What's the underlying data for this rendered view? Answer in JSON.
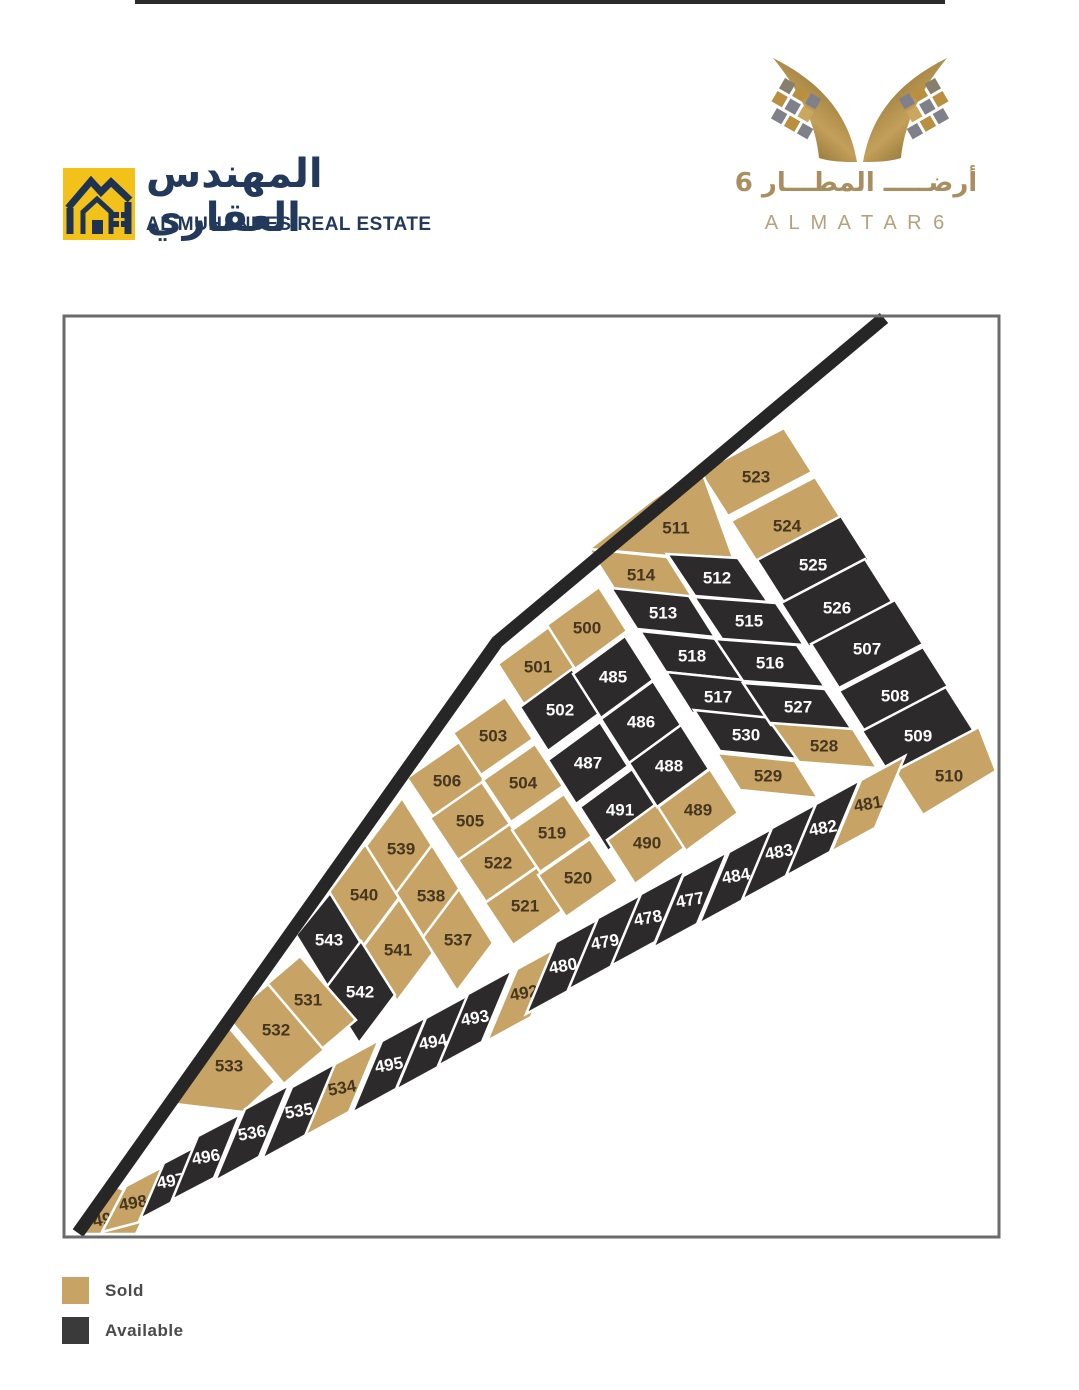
{
  "header": {
    "left": {
      "arabic_title": "المهندس العقاري",
      "english_title": "AL MUHANDES REAL ESTATE",
      "navy": "#22395B",
      "yellow": "#F2C21B"
    },
    "right": {
      "arabic_name": "أرضـــــ المطـــار 6",
      "latin_name": "A L M A T A R 6",
      "gold": "#A98E5F"
    }
  },
  "legend": {
    "items": [
      {
        "label": "Sold",
        "color": "#C7A365"
      },
      {
        "label": "Available",
        "color": "#3A3A3A"
      }
    ]
  },
  "map": {
    "frame": {
      "x": 64,
      "y": 316,
      "w": 935,
      "h": 921,
      "border": "#6b6b6b"
    },
    "road": {
      "points": "884,318 497,642 78,1233",
      "color": "#262626",
      "width": 13
    },
    "colors": {
      "sold": "#C7A365",
      "available": "#2D2A2B",
      "sold_text": "#45361F",
      "available_text": "#FFFFFF",
      "street": "#FFFFFF"
    },
    "plots": [
      {
        "n": "523",
        "s": "sold",
        "pts": "700,472 784,428 812,472 728,516",
        "lx": 756,
        "ly": 477,
        "rot": 0
      },
      {
        "n": "524",
        "s": "sold",
        "pts": "731,521 815,477 843,521 759,565",
        "lx": 787,
        "ly": 526,
        "rot": 0
      },
      {
        "n": "525",
        "s": "available",
        "pts": "757,560 841,516 869,560 785,604",
        "lx": 813,
        "ly": 565,
        "rot": 0
      },
      {
        "n": "526",
        "s": "available",
        "pts": "781,603 865,559 893,603 809,647",
        "lx": 837,
        "ly": 608,
        "rot": 0
      },
      {
        "n": "507",
        "s": "available",
        "pts": "811,644 895,600 923,644 839,688",
        "lx": 867,
        "ly": 649,
        "rot": 0
      },
      {
        "n": "508",
        "s": "available",
        "pts": "839,691 923,647 951,691 867,735",
        "lx": 895,
        "ly": 696,
        "rot": 0
      },
      {
        "n": "509",
        "s": "available",
        "pts": "862,731 946,687 974,731 890,775",
        "lx": 918,
        "ly": 736,
        "rot": 0
      },
      {
        "n": "510",
        "s": "sold",
        "pts": "895,771 979,727 996,771 923,815",
        "lx": 949,
        "ly": 776,
        "rot": 0
      },
      {
        "n": "511",
        "s": "sold",
        "pts": "589,549 652,500 700,466 734,560 668,556",
        "lx": 676,
        "ly": 528,
        "rot": 0
      },
      {
        "n": "514",
        "s": "sold",
        "pts": "589,549 667,557 693,598 615,590",
        "lx": 641,
        "ly": 575,
        "rot": 0
      },
      {
        "n": "513",
        "s": "available",
        "pts": "611,588 689,596 715,637 637,629",
        "lx": 663,
        "ly": 613,
        "rot": 0
      },
      {
        "n": "518",
        "s": "available",
        "pts": "640,631 718,639 744,680 666,672",
        "lx": 692,
        "ly": 656,
        "rot": 0
      },
      {
        "n": "517",
        "s": "available",
        "pts": "666,672 744,680 770,721 692,713",
        "lx": 718,
        "ly": 697,
        "rot": 0
      },
      {
        "n": "530",
        "s": "available",
        "pts": "694,710 772,718 798,759 720,751",
        "lx": 746,
        "ly": 735,
        "rot": 0
      },
      {
        "n": "529",
        "s": "sold",
        "pts": "717,753 795,761 818,798 740,790",
        "lx": 768,
        "ly": 776,
        "rot": 0
      },
      {
        "n": "512",
        "s": "available",
        "pts": "667,554 738,558 768,602 695,596",
        "lx": 717,
        "ly": 578,
        "rot": 0
      },
      {
        "n": "515",
        "s": "available",
        "pts": "694,597 776,603 804,645 722,639",
        "lx": 749,
        "ly": 621,
        "rot": 0
      },
      {
        "n": "516",
        "s": "available",
        "pts": "715,639 797,645 825,687 743,681",
        "lx": 770,
        "ly": 663,
        "rot": 0
      },
      {
        "n": "527",
        "s": "available",
        "pts": "743,683 825,689 853,731 771,725",
        "lx": 798,
        "ly": 707,
        "rot": 0
      },
      {
        "n": "528",
        "s": "sold",
        "pts": "771,723 853,729 877,768 799,762",
        "lx": 824,
        "ly": 746,
        "rot": 0
      },
      {
        "n": "501",
        "s": "sold",
        "pts": "498,664 550,626 578,670 526,708",
        "lx": 538,
        "ly": 667,
        "rot": 0
      },
      {
        "n": "502",
        "s": "available",
        "pts": "520,707 572,669 600,713 548,751",
        "lx": 560,
        "ly": 710,
        "rot": 0
      },
      {
        "n": "487",
        "s": "available",
        "pts": "548,760 600,722 628,766 576,804",
        "lx": 588,
        "ly": 763,
        "rot": 0
      },
      {
        "n": "491",
        "s": "available",
        "pts": "580,807 632,769 660,813 608,851",
        "lx": 620,
        "ly": 810,
        "rot": 0
      },
      {
        "n": "490",
        "s": "sold",
        "pts": "607,840 659,802 687,846 635,884",
        "lx": 647,
        "ly": 843,
        "rot": 0
      },
      {
        "n": "500",
        "s": "sold",
        "pts": "547,625 599,587 627,631 575,669",
        "lx": 587,
        "ly": 628,
        "rot": 0
      },
      {
        "n": "485",
        "s": "available",
        "pts": "573,674 625,636 653,680 601,718",
        "lx": 613,
        "ly": 677,
        "rot": 0
      },
      {
        "n": "486",
        "s": "available",
        "pts": "601,719 653,681 681,725 629,763",
        "lx": 641,
        "ly": 722,
        "rot": 0
      },
      {
        "n": "488",
        "s": "available",
        "pts": "629,763 681,725 709,769 657,807",
        "lx": 669,
        "ly": 766,
        "rot": 0
      },
      {
        "n": "489",
        "s": "sold",
        "pts": "658,807 710,769 738,813 686,851",
        "lx": 698,
        "ly": 810,
        "rot": 0
      },
      {
        "n": "506",
        "s": "sold",
        "pts": "407,778 459,742 487,784 435,820",
        "lx": 447,
        "ly": 781,
        "rot": 0
      },
      {
        "n": "505",
        "s": "sold",
        "pts": "430,818 482,782 510,824 458,860",
        "lx": 470,
        "ly": 821,
        "rot": 0
      },
      {
        "n": "522",
        "s": "sold",
        "pts": "458,860 510,824 538,866 486,902",
        "lx": 498,
        "ly": 863,
        "rot": 0
      },
      {
        "n": "521",
        "s": "sold",
        "pts": "485,903 537,867 565,909 513,945",
        "lx": 525,
        "ly": 906,
        "rot": 0
      },
      {
        "n": "503",
        "s": "sold",
        "pts": "453,733 505,697 533,739 481,775",
        "lx": 493,
        "ly": 736,
        "rot": 0
      },
      {
        "n": "504",
        "s": "sold",
        "pts": "483,780 535,744 563,786 511,822",
        "lx": 523,
        "ly": 783,
        "rot": 0
      },
      {
        "n": "519",
        "s": "sold",
        "pts": "512,830 564,794 592,836 540,872",
        "lx": 552,
        "ly": 833,
        "rot": 0
      },
      {
        "n": "520",
        "s": "sold",
        "pts": "538,875 590,839 618,881 566,917",
        "lx": 578,
        "ly": 878,
        "rot": 0
      },
      {
        "n": "539",
        "s": "sold",
        "pts": "402,798 436,852 400,900 366,846",
        "lx": 401,
        "ly": 849,
        "rot": 0
      },
      {
        "n": "540",
        "s": "sold",
        "pts": "365,844 399,898 363,946 329,892",
        "lx": 364,
        "ly": 895,
        "rot": 0
      },
      {
        "n": "543",
        "s": "available",
        "pts": "330,893 362,945 328,987 296,935",
        "lx": 329,
        "ly": 940,
        "rot": 0
      },
      {
        "n": "538",
        "s": "sold",
        "pts": "432,845 466,899 430,947 396,893",
        "lx": 431,
        "ly": 896,
        "rot": 0
      },
      {
        "n": "541",
        "s": "sold",
        "pts": "399,899 433,953 397,1001 363,947",
        "lx": 398,
        "ly": 950,
        "rot": 0
      },
      {
        "n": "542",
        "s": "available",
        "pts": "361,941 395,995 359,1043 325,989",
        "lx": 360,
        "ly": 992,
        "rot": 0
      },
      {
        "n": "537",
        "s": "sold",
        "pts": "459,889 493,943 457,991 423,937",
        "lx": 458,
        "ly": 940,
        "rot": 0
      },
      {
        "n": "531",
        "s": "sold",
        "pts": "300,956 356,1020 316,1054 260,990",
        "lx": 308,
        "ly": 1000,
        "rot": 0
      },
      {
        "n": "532",
        "s": "sold",
        "pts": "268,984 324,1050 284,1084 228,1018",
        "lx": 276,
        "ly": 1030,
        "rot": 0
      },
      {
        "n": "533",
        "s": "sold",
        "pts": "221,1018 275,1082 243,1112 175,1104",
        "lx": 229,
        "ly": 1066,
        "rot": 0
      },
      {
        "n": "499",
        "s": "sold",
        "pts": "75,1234 108,1184 152,1200 136,1234",
        "lx": 107,
        "ly": 1219,
        "rot": -10
      },
      {
        "n": "498",
        "s": "sold",
        "pts": "102,1232 126,1186 164,1166 140,1222",
        "lx": 133,
        "ly": 1203,
        "rot": -10
      },
      {
        "n": "497",
        "s": "available",
        "pts": "140,1219 164,1163 202,1143 178,1199",
        "lx": 171,
        "ly": 1181,
        "rot": -10
      },
      {
        "n": "496",
        "s": "available",
        "pts": "172,1200 198,1136 240,1114 214,1178",
        "lx": 206,
        "ly": 1157,
        "rot": -10
      },
      {
        "n": "536",
        "s": "available",
        "pts": "215,1181 245,1109 289,1085 259,1157",
        "lx": 252,
        "ly": 1133,
        "rot": -10
      },
      {
        "n": "535",
        "s": "available",
        "pts": "262,1159 292,1087 336,1063 306,1135",
        "lx": 299,
        "ly": 1111,
        "rot": -10
      },
      {
        "n": "534",
        "s": "sold",
        "pts": "305,1136 335,1064 379,1040 349,1112",
        "lx": 342,
        "ly": 1088,
        "rot": -10
      },
      {
        "n": "495",
        "s": "available",
        "pts": "352,1113 382,1041 426,1017 396,1089",
        "lx": 389,
        "ly": 1065,
        "rot": -10
      },
      {
        "n": "494",
        "s": "available",
        "pts": "396,1090 426,1018 470,994 440,1066",
        "lx": 433,
        "ly": 1042,
        "rot": -10
      },
      {
        "n": "493",
        "s": "available",
        "pts": "438,1066 468,994 512,970 482,1042",
        "lx": 475,
        "ly": 1018,
        "rot": -10
      },
      {
        "n": "492",
        "s": "sold",
        "pts": "487,1041 517,969 561,945 531,1017",
        "lx": 524,
        "ly": 993,
        "rot": -10
      },
      {
        "n": "480",
        "s": "available",
        "pts": "526,1014 556,942 600,918 570,990",
        "lx": 563,
        "ly": 966,
        "rot": -10
      },
      {
        "n": "479",
        "s": "available",
        "pts": "568,990 598,918 642,894 612,966",
        "lx": 605,
        "ly": 942,
        "rot": -10
      },
      {
        "n": "478",
        "s": "available",
        "pts": "611,966 641,894 685,870 655,942",
        "lx": 648,
        "ly": 918,
        "rot": -10
      },
      {
        "n": "477",
        "s": "available",
        "pts": "653,948 683,876 727,852 697,924",
        "lx": 690,
        "ly": 900,
        "rot": -10
      },
      {
        "n": "484",
        "s": "available",
        "pts": "699,924 729,852 773,828 743,900",
        "lx": 736,
        "ly": 876,
        "rot": -10
      },
      {
        "n": "483",
        "s": "available",
        "pts": "742,900 772,828 816,804 786,876",
        "lx": 779,
        "ly": 852,
        "rot": -10
      },
      {
        "n": "482",
        "s": "available",
        "pts": "786,876 816,804 860,780 830,852",
        "lx": 823,
        "ly": 828,
        "rot": -10
      },
      {
        "n": "481",
        "s": "sold",
        "pts": "831,852 861,780 905,756 875,828",
        "lx": 868,
        "ly": 804,
        "rot": -10
      }
    ]
  }
}
